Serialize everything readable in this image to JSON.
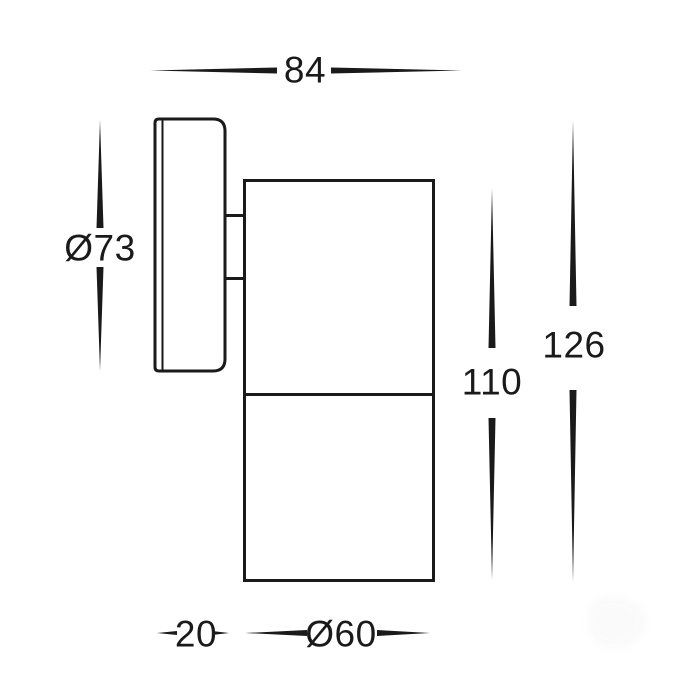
{
  "page": {
    "background": "#ffffff",
    "line_color": "#1a1a1a",
    "drawing_type": "technical dimension drawing, side view of wall-mounted cylindrical spotlight"
  },
  "dim_labels": {
    "overall_depth": "84",
    "plate_diameter": "Ø73",
    "body_height": "110",
    "overall_height": "126",
    "plate_depth": "20",
    "body_diameter": "Ø60"
  }
}
